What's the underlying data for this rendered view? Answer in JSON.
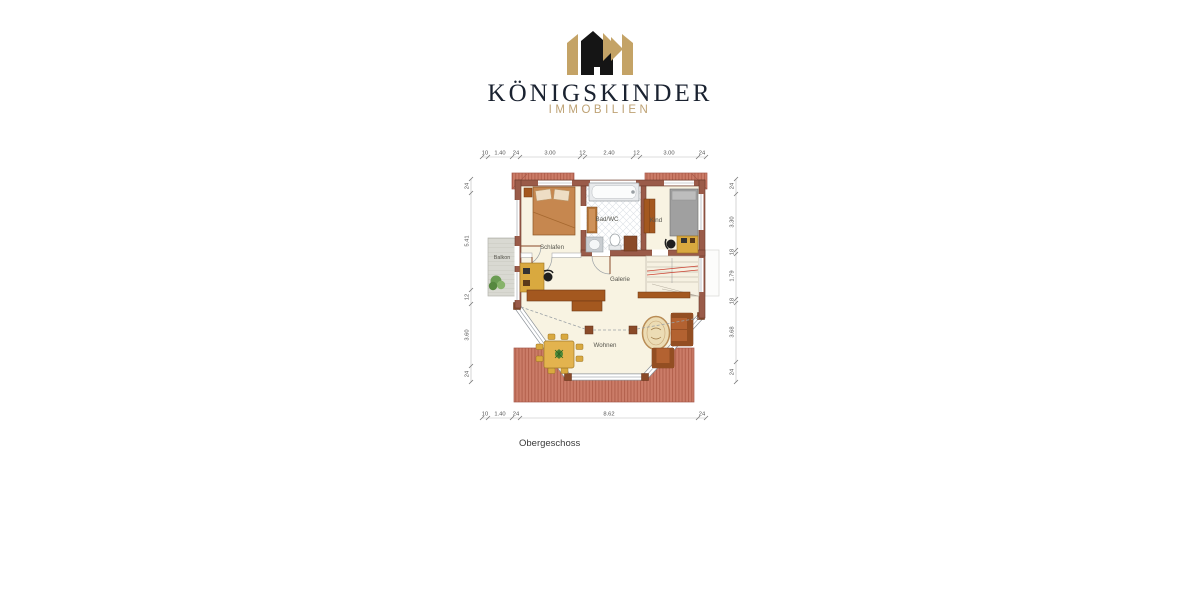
{
  "brand": {
    "name": "KÖNIGSKINDER",
    "subtitle": "IMMOBILIEN",
    "name_color": "#1a2230",
    "subtitle_color": "#bea274",
    "crown_gold": "#c4a366",
    "crown_black": "#151515"
  },
  "floorplan": {
    "title": "Obergeschoss",
    "rooms": {
      "schlafen": "Schlafen",
      "bad": "Bad/WC",
      "kind": "Kind",
      "balkon": "Balkon",
      "galerie": "Galerie",
      "wohnen": "Wohnen"
    },
    "dimensions": {
      "top": [
        "10",
        "1.40",
        "24",
        "3.00",
        "12",
        "2.40",
        "12",
        "3.00",
        "24"
      ],
      "bottom": [
        "10",
        "1.40",
        "24",
        "8.62",
        "24"
      ],
      "left": [
        "24",
        "5.41",
        "12",
        "3.60",
        "24"
      ],
      "right": [
        "24",
        "3.30",
        "18",
        "1.79",
        "18",
        "3.68",
        "24"
      ]
    },
    "colors": {
      "wall": "#9a5b49",
      "floor": "#f8f3e2",
      "roof": "#cb7c68",
      "wood": "#a4581f",
      "furniture_tan": "#d9a93f"
    }
  }
}
